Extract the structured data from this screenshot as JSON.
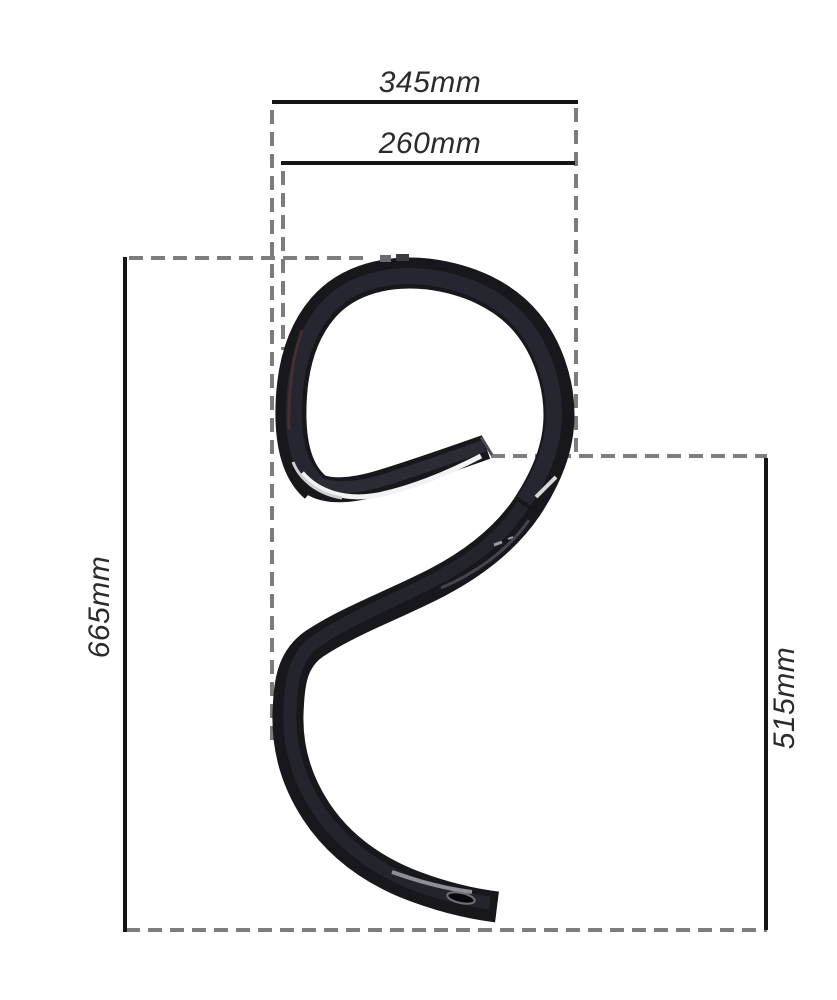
{
  "diagram": {
    "title": "spring-tine-dimension-diagram",
    "dimensions": {
      "top_width": "345mm",
      "coil_width": "260mm",
      "overall_height": "665mm",
      "leg_height": "515mm"
    },
    "colors": {
      "background": "#ffffff",
      "dimension_line": "#161616",
      "extension_line": "#7d7d7d",
      "label_text": "#2b2b2b",
      "part_body": "#17171c",
      "part_highlight": "#f2f2f4"
    }
  }
}
